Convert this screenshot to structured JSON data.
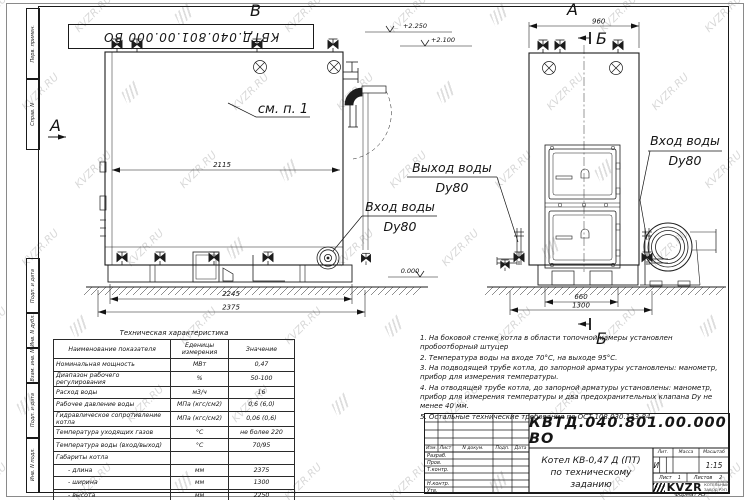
{
  "watermark": {
    "text": "KVZR.RU"
  },
  "stamp_top": "КВТД.040.801.00.000 ВО",
  "sidebar": {
    "labels_top": [
      "Перв. примен.",
      "Справ. N"
    ],
    "labels_bottom": [
      "Подп. и дата",
      "Инв. N дубл.",
      "Взам. инв. N",
      "Подп. и дата",
      "Инв. N подл."
    ]
  },
  "drawing": {
    "side_view": {
      "letter_top": "В",
      "letter_side": "А",
      "detail_note": "см. п. 1",
      "dim_width_inner": "2115",
      "dim_base": "2245",
      "dim_length": "2375",
      "elev_top": "+2.250",
      "elev_mid": "+2.100",
      "elev_zero": "0.000",
      "inlet_line1": "Вход воды",
      "inlet_line2": "Dу80"
    },
    "front_view": {
      "letter_top": "А",
      "dim_top": "960",
      "section_letter_top": "Б",
      "section_letter_bottom": "Б",
      "dim_base": "660",
      "dim_length": "1300",
      "outlet_line1": "Выход воды",
      "outlet_line2": "Dу80",
      "inlet_line1": "Вход воды",
      "inlet_line2": "Dу80"
    }
  },
  "spec_table": {
    "title": "Техническая характеристика",
    "headers": [
      "Наименование показателя",
      "Еденицы\nизмерения",
      "Значение"
    ],
    "rows": [
      [
        "Номинальная мощность",
        "МВт",
        "0,47"
      ],
      [
        "Диапазон рабочего регулирования",
        "%",
        "50-100"
      ],
      [
        "Расход воды",
        "м3/ч",
        "16"
      ],
      [
        "Рабочее давление воды",
        "МПа (кгс/см2)",
        "0,6 (6,0)"
      ],
      [
        "Гидравлическое сопротивление котла",
        "МПа (кгс/см2)",
        "0,06 (0,6)"
      ],
      [
        "Температура уходящих газов",
        "°С",
        "не более 220"
      ],
      [
        "Температура воды (вход/выход)",
        "°С",
        "70/95"
      ],
      [
        "Габариты котла",
        "",
        ""
      ],
      [
        "- длина",
        "мм",
        "2375"
      ],
      [
        "- ширина",
        "мм",
        "1300"
      ],
      [
        "- высота",
        "мм",
        "2250"
      ]
    ]
  },
  "notes": [
    "1.  На боковой стенке котла в области топочной камеры установлен пробоотборный штуцер",
    "2.  Температура воды на входе  70°С, на выходе  95°С.",
    "3.  На подводящей трубе котла, до запорной арматуры установлены: манометр, прибор для измерения температуры.",
    "4.  На отводящей трубе котла, до запорной арматуры установлены: манометр, прибор для измерения температуры и два предохранительных клапана  Dу не менее  40 мм.",
    "5.  Остальные технические требования по ОСТ  108.030.133-84."
  ],
  "title_block": {
    "doc_number": "КВТД.040.801.00.000  ВО",
    "header_cols": [
      "Изм.",
      "Лист",
      "N докум.",
      "Подп.",
      "Дата"
    ],
    "left_rows": [
      "Разраб.",
      "Пров.",
      "Т.контр.",
      "",
      "Н.контр.",
      "Утв."
    ],
    "title_line1": "Котел  КВ-0,47  Д  (ПТ)",
    "title_line2": "по техническому заданию",
    "lit_label": "Лит.",
    "mass_label": "Масса",
    "scale_label": "Масштаб",
    "lit_value": "И",
    "scale_value": "1:15",
    "sheet_label": "Лист",
    "sheet_value": "1",
    "sheets_label": "Листов",
    "sheets_value": "2",
    "company_logo": "KVZR",
    "company_line1": "КОТЕЛЬНЫЙ",
    "company_line2": "ЗАВОД РЭП"
  },
  "format_label": "Формат  А3"
}
